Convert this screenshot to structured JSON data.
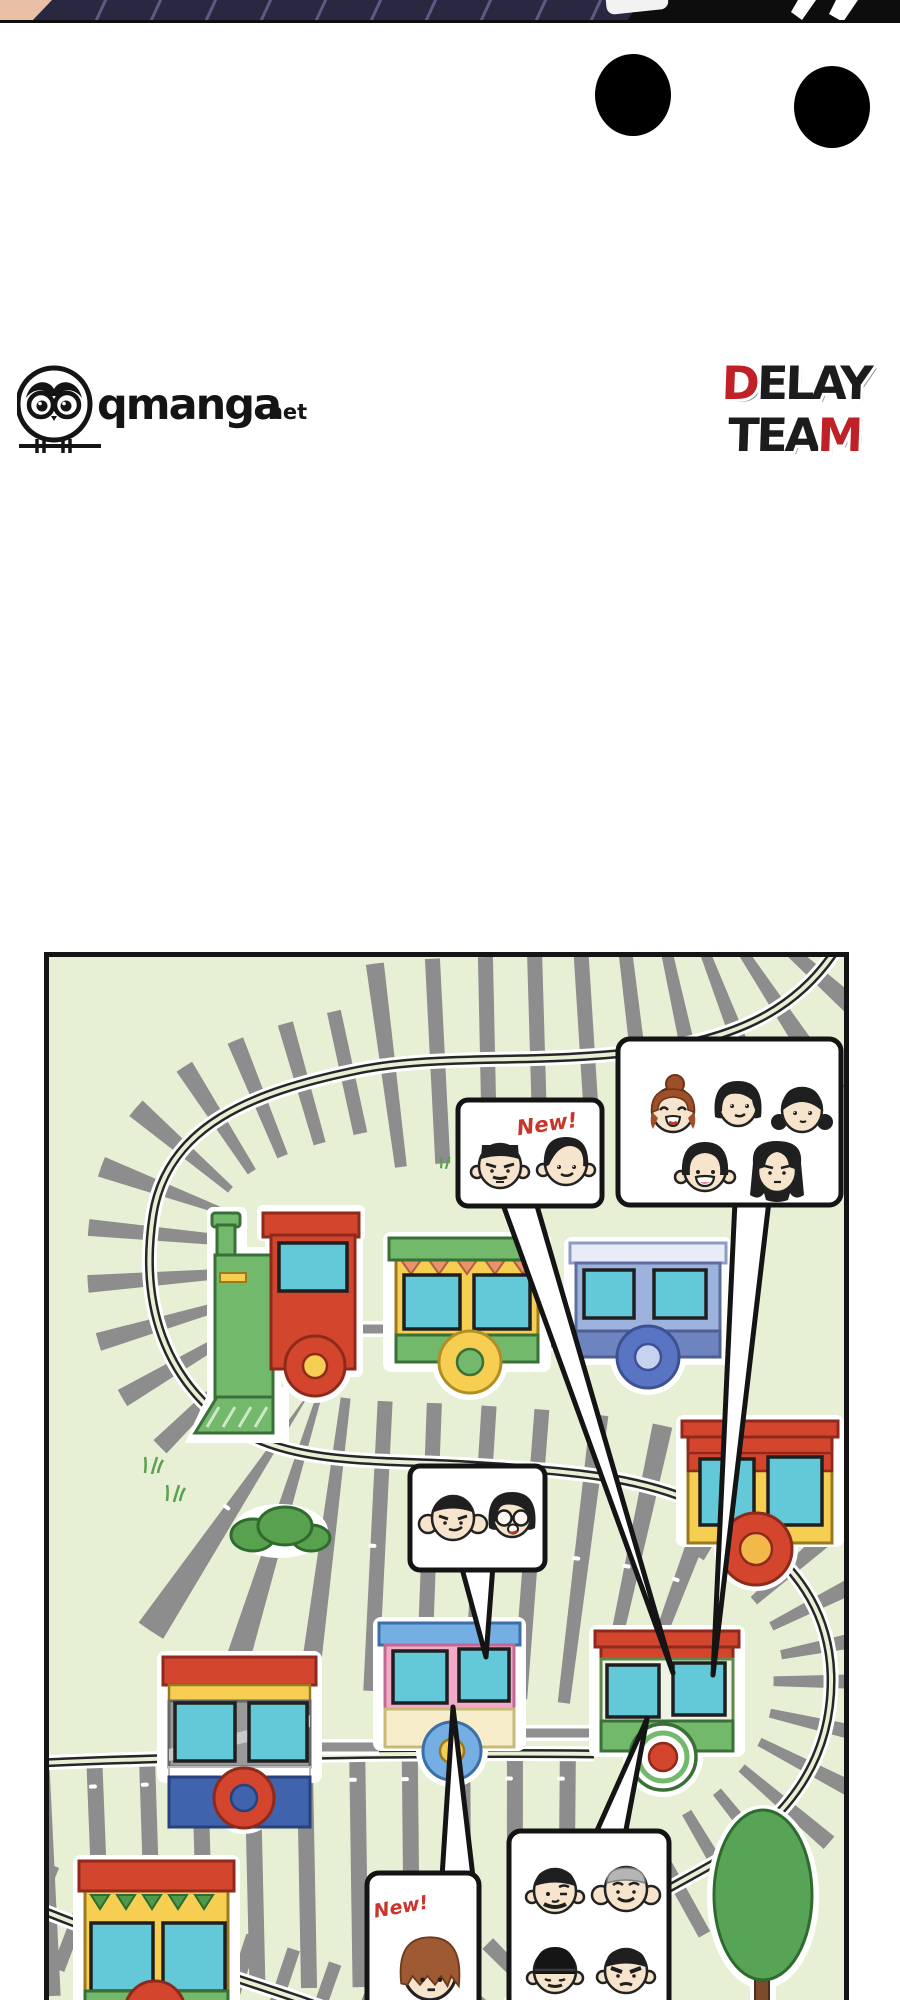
{
  "page_type": "webtoon transition page",
  "palette": {
    "panel_bg": "#e7f0d4",
    "ink": "#141414",
    "track_tie": "#8d8d8d",
    "rail": "#2a2a2a",
    "train_red": "#d4452e",
    "train_red_dark": "#8d2a1c",
    "train_green": "#72b96b",
    "train_green_dark": "#3a6f38",
    "train_yellow": "#f6cf52",
    "window_cyan": "#63c9d9",
    "wagon_blue": "#9db3de",
    "wagon_blue_band": "#6e84c0",
    "wagon_navy": "#3f63ad",
    "wagon_pink": "#f4a9c6",
    "cream": "#f8edca",
    "wheel_blue": "#5a74c4",
    "bush_green": "#58a14e",
    "tree_green": "#57a457",
    "trunk_brown": "#7a4a2b",
    "skin": "#f6e4cc",
    "hair_black": "#1f1f1f",
    "hair_gray": "#b5b5b5",
    "hair_brown": "#9d5a33",
    "new_red": "#c9352b",
    "strip_navy": "#2a2741",
    "strip_black": "#0d0d0d",
    "strip_skin": "#e9c0a6"
  },
  "top_strip": {
    "description": "bottom sliver of previous manga panel"
  },
  "transition_dots": {
    "count": 2,
    "color": "#000000"
  },
  "logos": {
    "qmanga": {
      "name": "qmanga.net",
      "text": "qmanga",
      "suffix": ".net"
    },
    "delay_team": {
      "line1": "DELAY",
      "line2": "TEAM",
      "line1_red": "D",
      "line1_rest": "ELAY",
      "line2_rest": "TEA",
      "line2_red": "M",
      "red": "#bf2126",
      "dark": "#1c1c1c"
    }
  },
  "panel": {
    "scene": "toy train track map with character face speech bubbles",
    "bubbles": [
      {
        "id": "top-new",
        "label": "New!",
        "faces": [
          "man flat-top stern",
          "man mop-top smiling"
        ]
      },
      {
        "id": "top-group",
        "label": "",
        "faces": [
          "woman auburn bun laughing",
          "woman black bob smiling",
          "girl black pigtails",
          "boy bowl-cut grinning",
          "woman long black hair stern"
        ]
      },
      {
        "id": "mid-pair",
        "label": "",
        "faces": [
          "man crew-cut smirk",
          "woman bob with glasses smiling"
        ]
      },
      {
        "id": "bottom-new",
        "label": "New!",
        "faces": [
          "person shaggy auburn hair"
        ]
      },
      {
        "id": "bottom-group",
        "label": "",
        "faces": [
          "man short beard wink",
          "man gray hair grinning",
          "man black beanie mustache",
          "man angry frown"
        ]
      }
    ],
    "trains": [
      {
        "id": "locomotive",
        "colors": [
          "red",
          "green",
          "yellow"
        ]
      },
      {
        "id": "wagon-green-yellow",
        "colors": [
          "green",
          "yellow",
          "cyan"
        ]
      },
      {
        "id": "wagon-blue",
        "colors": [
          "periwinkle",
          "cyan"
        ]
      },
      {
        "id": "wagon-red-yellow",
        "colors": [
          "red",
          "yellow",
          "cyan"
        ]
      },
      {
        "id": "wagon-navy-gray",
        "colors": [
          "red",
          "gray",
          "navy",
          "cyan"
        ]
      },
      {
        "id": "wagon-pink-blue",
        "colors": [
          "blue",
          "pink",
          "cream",
          "cyan"
        ]
      },
      {
        "id": "wagon-green-white",
        "colors": [
          "red",
          "white",
          "green",
          "cyan"
        ]
      },
      {
        "id": "wagon-yellow-bunting",
        "colors": [
          "red",
          "yellow",
          "green",
          "cyan"
        ]
      }
    ],
    "scenery": [
      "bush",
      "grass tufts",
      "tree"
    ]
  }
}
